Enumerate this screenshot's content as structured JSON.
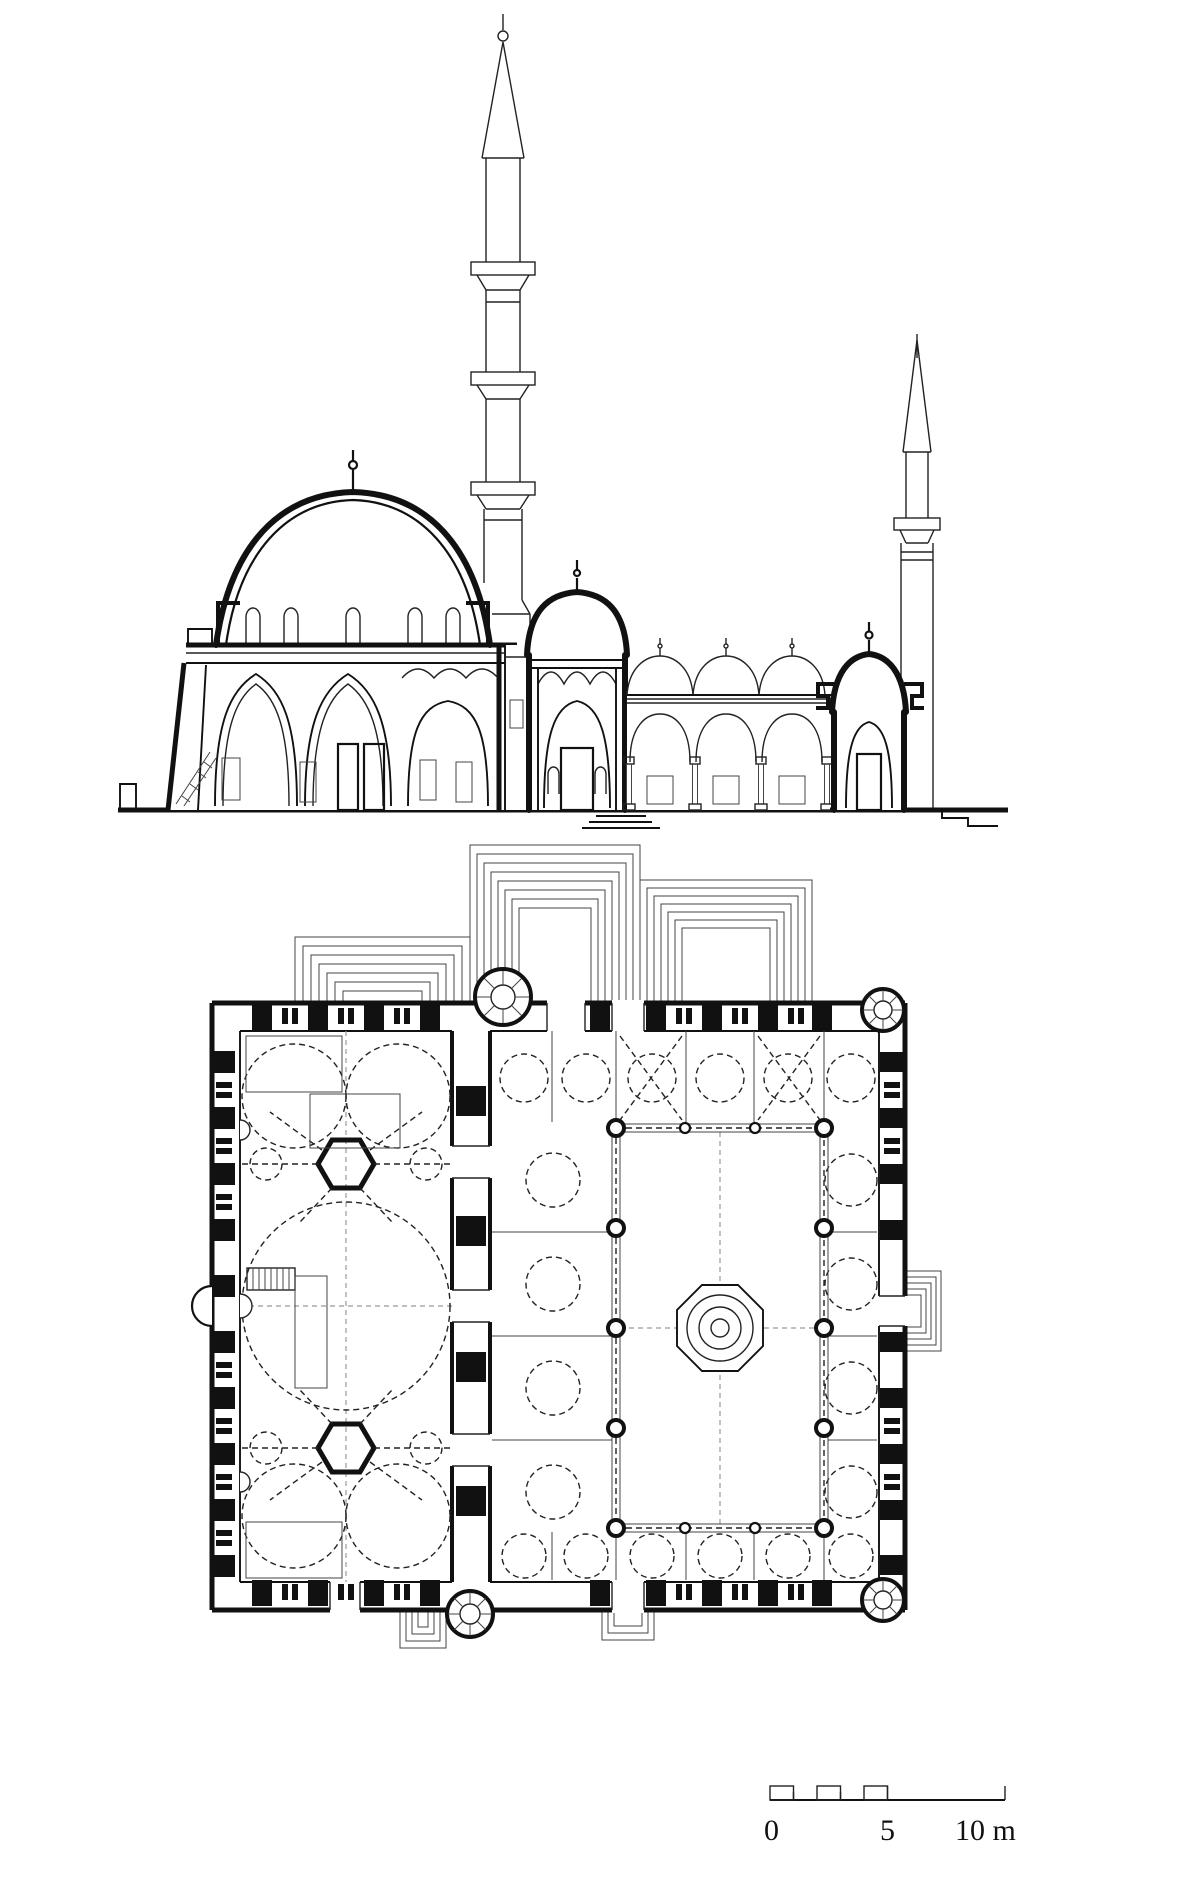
{
  "views": {
    "top": "longitudinal-section-of-mosque",
    "bottom": "ground-floor-plan"
  },
  "scale_bar": {
    "labels": [
      "0",
      "5",
      "10 m"
    ],
    "values_m": [
      0,
      5,
      10
    ],
    "unit": "m"
  },
  "colors": {
    "background": "#ffffff",
    "ink": "#111111"
  }
}
